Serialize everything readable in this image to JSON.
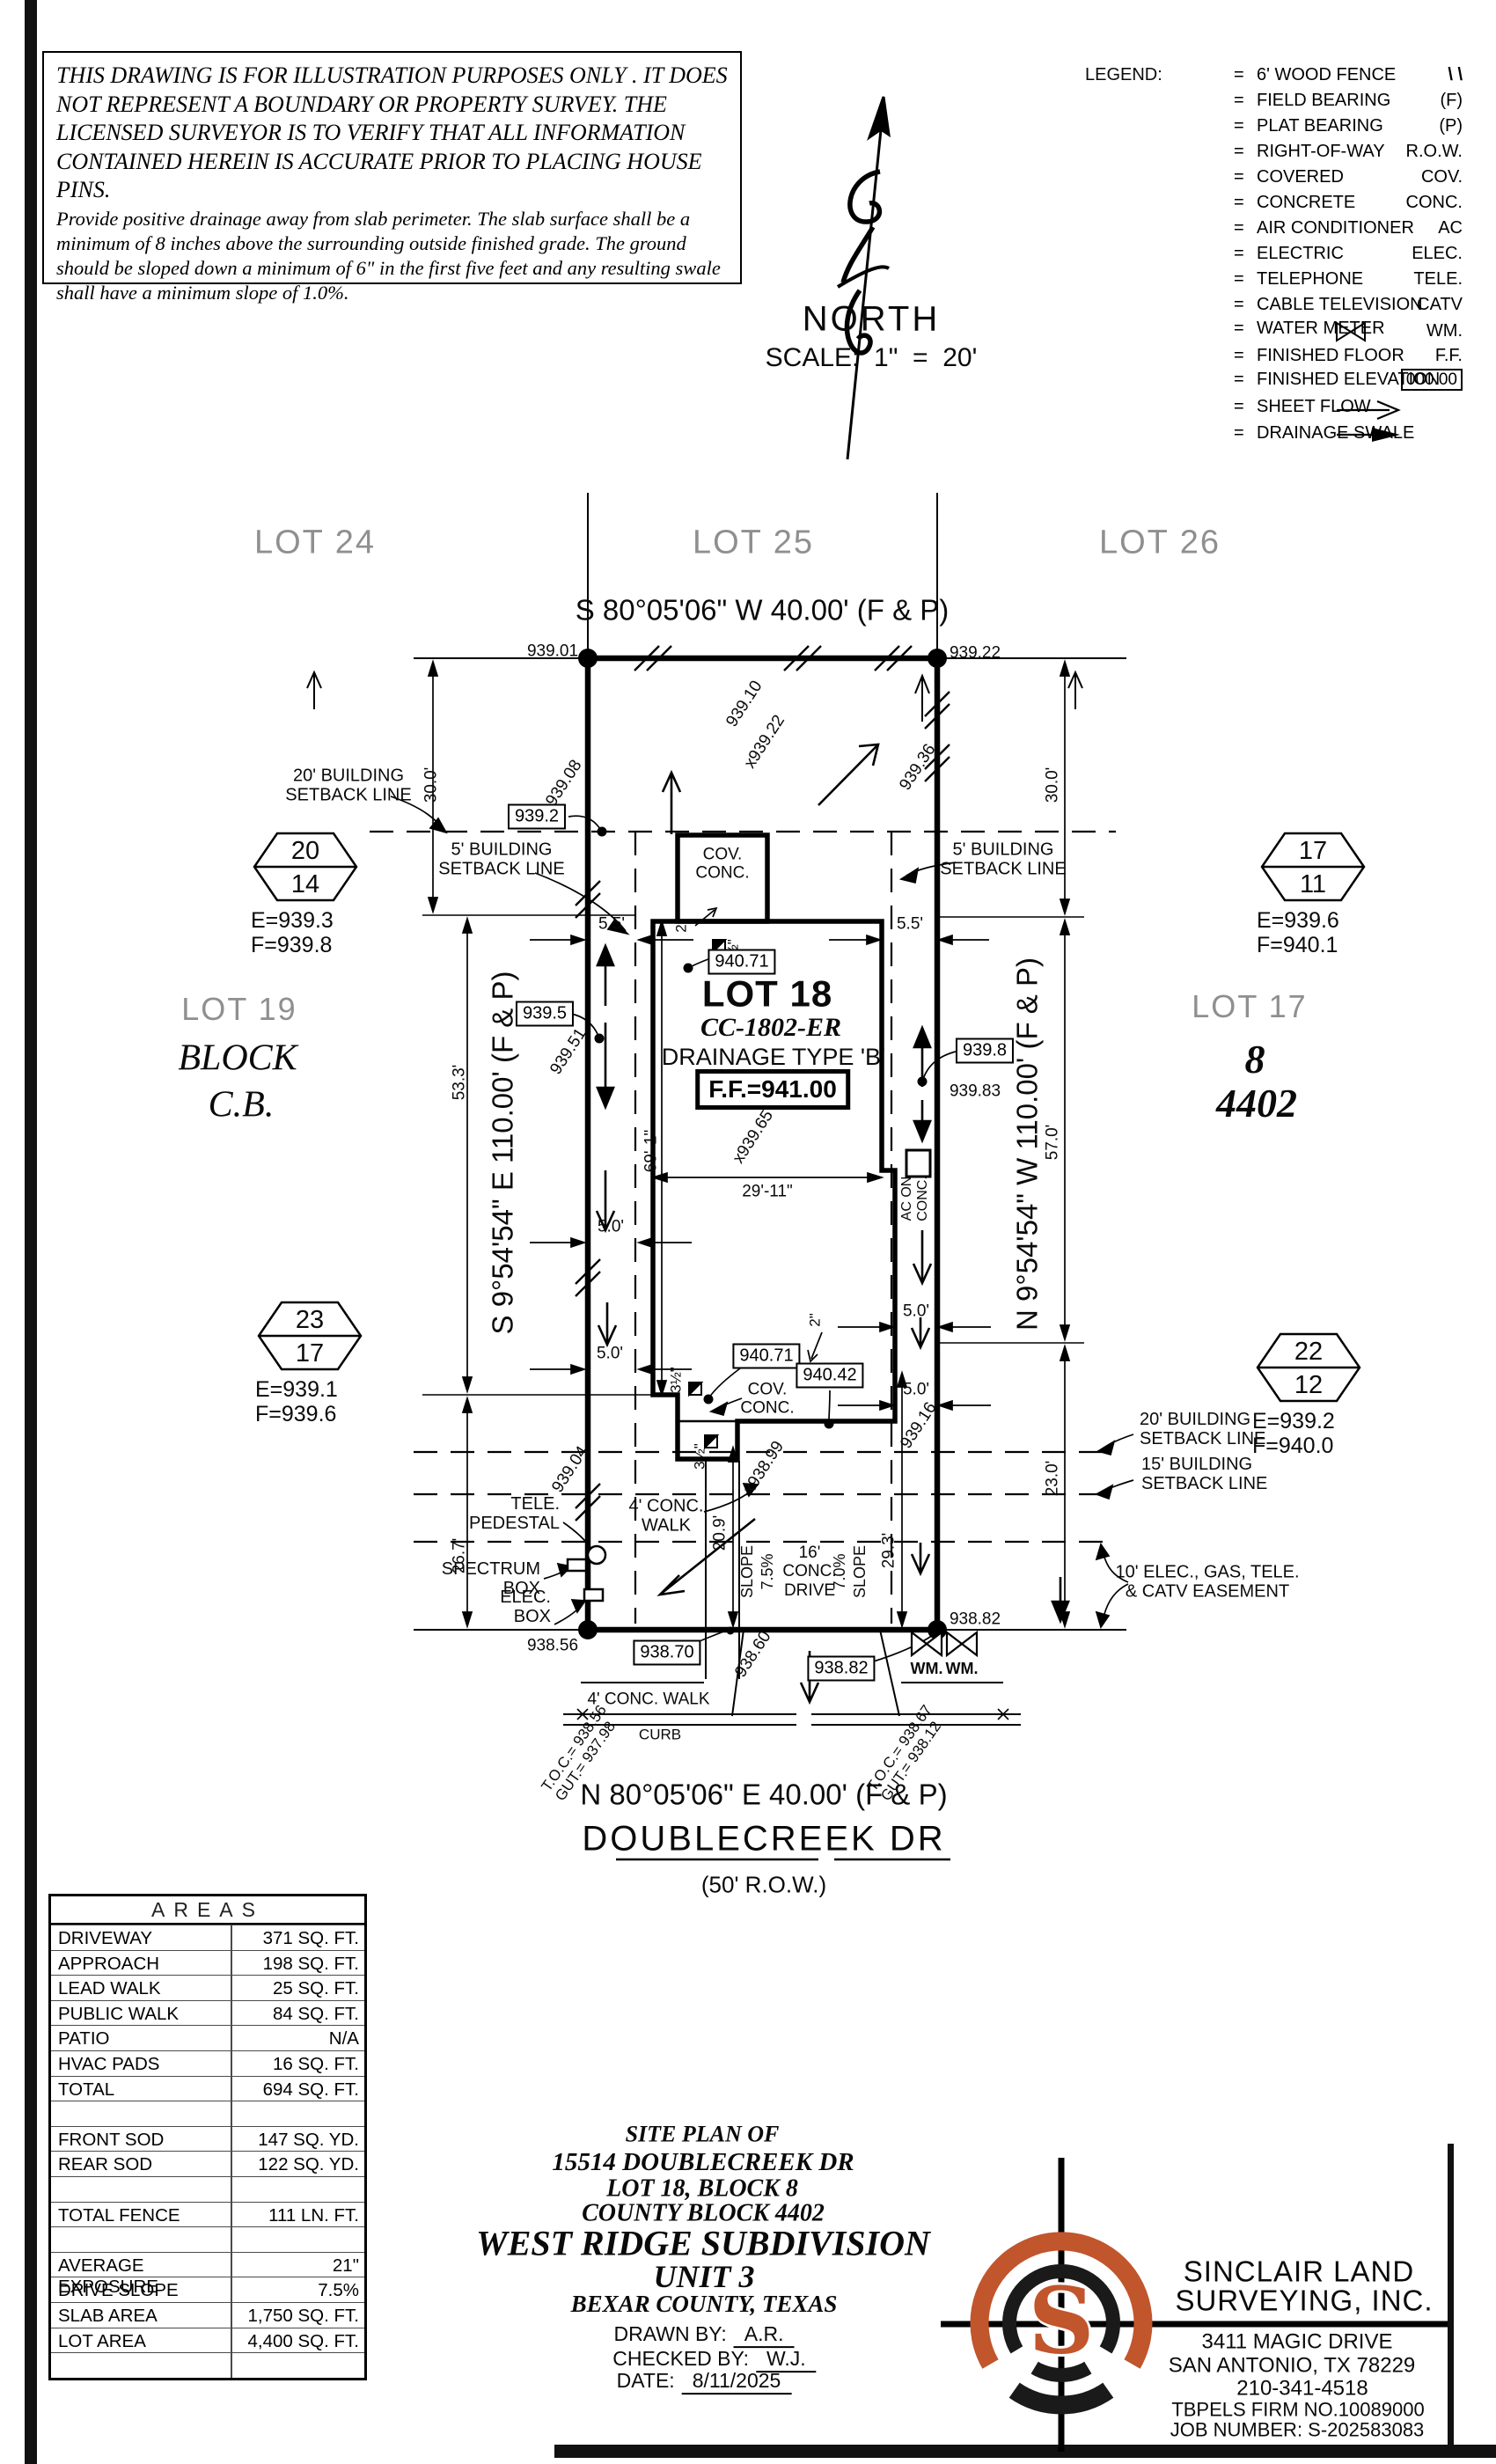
{
  "colors": {
    "accent": "#c1552c",
    "ink": "#000000",
    "muted": "#8f8f8f"
  },
  "disclaimer": {
    "para1": "THIS DRAWING IS FOR ILLUSTRATION PURPOSES ONLY . IT DOES NOT REPRESENT A BOUNDARY OR PROPERTY SURVEY. THE LICENSED SURVEYOR IS TO VERIFY THAT ALL INFORMATION CONTAINED HEREIN IS ACCURATE PRIOR TO PLACING HOUSE PINS.",
    "para2": "Provide positive drainage away from slab perimeter. The slab surface shall be a minimum of 8 inches above the surrounding outside finished grade. The ground should be sloped down a minimum of 6\" in the first five feet and any resulting swale shall have a minimum slope of 1.0%."
  },
  "north": {
    "label": "NORTH",
    "scale": "SCALE:  1\"  =  20'"
  },
  "legend": {
    "title": "LEGEND:",
    "items": [
      {
        "sym": "\\ \\",
        "label": "6' WOOD FENCE"
      },
      {
        "sym": "(F)",
        "label": "FIELD BEARING"
      },
      {
        "sym": "(P)",
        "label": "PLAT BEARING"
      },
      {
        "sym": "R.O.W.",
        "label": "RIGHT-OF-WAY"
      },
      {
        "sym": "COV.",
        "label": "COVERED"
      },
      {
        "sym": "CONC.",
        "label": "CONCRETE"
      },
      {
        "sym": "AC",
        "label": "AIR CONDITIONER"
      },
      {
        "sym": "ELEC.",
        "label": "ELECTRIC"
      },
      {
        "sym": "TELE.",
        "label": "TELEPHONE"
      },
      {
        "sym": "CATV",
        "label": "CABLE TELEVISION"
      },
      {
        "sym": "WM.",
        "label": "WATER METER"
      },
      {
        "sym": "F.F.",
        "label": "FINISHED FLOOR"
      },
      {
        "sym": "000.00",
        "label": "FINISHED ELEVATION"
      },
      {
        "sym": "",
        "label": "SHEET FLOW"
      },
      {
        "sym": "",
        "label": "DRAINAGE SWALE"
      }
    ]
  },
  "adjacent_lots": {
    "lot24": "LOT 24",
    "lot25": "LOT 25",
    "lot26": "LOT 26",
    "lot19": "LOT 19",
    "block": "BLOCK",
    "block_cb": "C.B.",
    "lot17": "LOT 17",
    "block8": "8",
    "cb4402": "4402"
  },
  "bearings": {
    "rear": "S 80°05'06\" W 40.00' (F & P)",
    "front": "N 80°05'06\" E 40.00' (F & P)",
    "east": "S 9°54'54\" E 110.00' (F & P)",
    "west": "N 9°54'54\" W 110.00' (F & P)"
  },
  "street": {
    "name": "DOUBLECREEK DR",
    "row": "(50' R.O.W.)"
  },
  "lot18": {
    "name": "LOT 18",
    "plan_code": "CC-1802-ER",
    "drainage": "DRAINAGE TYPE 'B'",
    "finished_floor": "F.F.=941.00"
  },
  "monuments": [
    {
      "top": "20",
      "bottom": "14",
      "e": "E=939.3",
      "f": "F=939.8"
    },
    {
      "top": "17",
      "bottom": "11",
      "e": "E=939.6",
      "f": "F=940.1"
    },
    {
      "top": "23",
      "bottom": "17",
      "e": "E=939.1",
      "f": "F=939.6"
    },
    {
      "top": "22",
      "bottom": "12",
      "e": "E=939.2",
      "f": "F=940.0"
    }
  ],
  "boxed_elevations": {
    "rear_setback": "939.2",
    "house_rear": "940.71",
    "east_mid": "939.5",
    "west_mid": "939.8",
    "walk": "940.71",
    "patio": "940.42",
    "apron": "938.70",
    "drive": "938.82"
  },
  "spot_elevations": {
    "rear_left": "939.01",
    "rear_right": "939.22",
    "e1": "939.08",
    "e2": "939.10",
    "e3": "x939.22",
    "e4": "939.36",
    "e5": "939.51",
    "e6": "x939.65",
    "e7": "939.83",
    "e8": "939.04",
    "e9": "x938.99",
    "e10": "939.16",
    "e11": "938.60",
    "front_left": "938.56",
    "front_right": "938.82"
  },
  "dims": {
    "d30": "30.0'",
    "d533": "53.3'",
    "d267": "26.7'",
    "d570": "57.0'",
    "d230": "23.0'",
    "d55": "5.5'",
    "d50": "5.0'",
    "d209": "20.9'",
    "d293": "29.3'",
    "d691": "69'-1\"",
    "d2911": "29'-11\"",
    "d2": "2\"",
    "d35": "3½\""
  },
  "features": {
    "sb20_1": "20' BUILDING",
    "sb20_2": "SETBACK LINE",
    "sb5_1": "5' BUILDING",
    "sb5_2": "SETBACK LINE",
    "sb15_1": "15' BUILDING",
    "sb15_2": "SETBACK LINE",
    "esmt_1": "10' ELEC., GAS, TELE.",
    "esmt_2": "& CATV EASEMENT",
    "cov": "COV.",
    "conc": "CONC.",
    "ac_1": "AC ON",
    "ac_2": "CONC.",
    "tele_1": "TELE.",
    "tele_2": "PEDESTAL",
    "spectrum_1": "SPECTRUM",
    "spectrum_2": "BOX",
    "elec_1": "ELEC.",
    "elec_2": "BOX",
    "walk_1": "4' CONC.",
    "walk_2": "WALK",
    "walk_street": "4' CONC. WALK",
    "curb": "CURB",
    "slope": "SLOPE",
    "slope_a": "7.5%",
    "slope_b": "7.0%",
    "drive_1": "16'",
    "drive_2": "CONC.",
    "drive_3": "DRIVE",
    "wm": "WM."
  },
  "toc": {
    "left_1": "T.O.C.= 938.56",
    "left_2": "GUT.= 937.98",
    "right_1": "T.O.C.= 938.67",
    "right_2": "GUT.= 938.12"
  },
  "areas": {
    "title": "AREAS",
    "rows": [
      {
        "label": "DRIVEWAY",
        "value": "371 SQ. FT."
      },
      {
        "label": "APPROACH",
        "value": "198 SQ. FT."
      },
      {
        "label": "LEAD WALK",
        "value": "25 SQ. FT."
      },
      {
        "label": "PUBLIC WALK",
        "value": "84 SQ. FT."
      },
      {
        "label": "PATIO",
        "value": "N/A"
      },
      {
        "label": "HVAC PADS",
        "value": "16 SQ. FT."
      },
      {
        "label": "TOTAL",
        "value": "694 SQ. FT."
      },
      {
        "label": "",
        "value": ""
      },
      {
        "label": "FRONT SOD",
        "value": "147 SQ. YD."
      },
      {
        "label": "REAR SOD",
        "value": "122 SQ. YD."
      },
      {
        "label": "",
        "value": ""
      },
      {
        "label": "TOTAL FENCE",
        "value": "111 LN. FT."
      },
      {
        "label": "",
        "value": ""
      },
      {
        "label": "AVERAGE EXPOSURE",
        "value": "21\""
      },
      {
        "label": "DRIVE SLOPE",
        "value": "7.5%"
      },
      {
        "label": "SLAB AREA",
        "value": "1,750 SQ. FT."
      },
      {
        "label": "LOT AREA",
        "value": "4,400 SQ. FT."
      },
      {
        "label": "",
        "value": ""
      }
    ]
  },
  "title_block": {
    "l1": "SITE PLAN OF",
    "l2": "15514 DOUBLECREEK DR",
    "l3": "LOT 18, BLOCK 8",
    "l4": "COUNTY BLOCK 4402",
    "l5": "WEST RIDGE SUBDIVISION",
    "l6": "UNIT 3",
    "l7": "BEXAR COUNTY, TEXAS",
    "drawn_label": "DRAWN BY:",
    "drawn": "A.R.",
    "checked_label": "CHECKED BY:",
    "checked": "W.J.",
    "date_label": "DATE:",
    "date": "8/11/2025"
  },
  "firm": {
    "logo_letter": "S",
    "name1": "SINCLAIR LAND",
    "name2": "SURVEYING, INC.",
    "addr1": "3411 MAGIC DRIVE",
    "addr2": "SAN ANTONIO, TX 78229",
    "phone": "210-341-4518",
    "tbpels": "TBPELS FIRM NO.10089000",
    "job": "JOB NUMBER: S-202583083"
  }
}
